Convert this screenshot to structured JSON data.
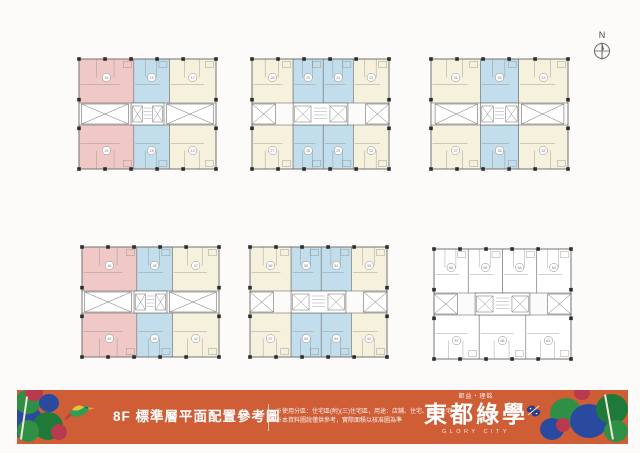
{
  "north_indicator": {
    "label": "N"
  },
  "banner": {
    "bg_color": "#cf5e37",
    "title": "8F 標準層平面配置參考圖",
    "disclaimer_line1": "※使用分區：住宅區(附)(三)住宅區，用途：店鋪、住宅、集合住宅",
    "disclaimer_line2": "※本資料圖說僅供參考，實際面積以核准圖為準",
    "developer": "鉅益・理銘",
    "brand": "東都綠學",
    "brand_en": "GLORY CITY"
  },
  "palette": {
    "pink": "#f0c9c6",
    "blue": "#c2ddec",
    "cream": "#f6f1dc",
    "white": "#ffffff",
    "line": "#6e6e6e",
    "detail": "#8b8b8b",
    "column": "#2d2d2d",
    "treeGreen": "#2f8f45",
    "treeGreenDark": "#1f7a3a",
    "treeBlue": "#2a4a9f",
    "flower": "#b93a4e",
    "trunk": "#efe8d8"
  },
  "plans": [
    {
      "id": "plan-1",
      "rows": [
        {
          "units": [
            {
              "color": "pink",
              "w": 0.4,
              "label": "16"
            },
            {
              "color": "blue",
              "w": 0.26,
              "label": "15"
            },
            {
              "color": "cream",
              "w": 0.34,
              "label": "17"
            }
          ]
        },
        {
          "units": [
            {
              "color": "pink",
              "w": 0.4,
              "label": "19"
            },
            {
              "color": "blue",
              "w": 0.26,
              "label": "18"
            },
            {
              "color": "cream",
              "w": 0.34,
              "label": "12"
            }
          ]
        }
      ],
      "wells": [
        [
          0.02,
          0.36
        ],
        [
          0.64,
          0.98
        ]
      ],
      "core": [
        0.38,
        0.62
      ]
    },
    {
      "id": "plan-2",
      "rows": [
        {
          "units": [
            {
              "color": "cream",
              "w": 0.3,
              "label": "26"
            },
            {
              "color": "blue",
              "w": 0.22,
              "label": "25"
            },
            {
              "color": "blue",
              "w": 0.22,
              "label": "24"
            },
            {
              "color": "cream",
              "w": 0.26,
              "label": "23"
            }
          ]
        },
        {
          "units": [
            {
              "color": "cream",
              "w": 0.3,
              "label": "27"
            },
            {
              "color": "blue",
              "w": 0.22,
              "label": "28"
            },
            {
              "color": "blue",
              "w": 0.22,
              "label": "29"
            },
            {
              "color": "cream",
              "w": 0.26,
              "label": "22"
            }
          ]
        }
      ],
      "wells": [
        [
          0.0,
          0.17
        ],
        [
          0.83,
          1.0
        ]
      ],
      "core": [
        0.3,
        0.7
      ]
    },
    {
      "id": "plan-3",
      "rows": [
        {
          "units": [
            {
              "color": "cream",
              "w": 0.36,
              "label": "36"
            },
            {
              "color": "blue",
              "w": 0.28,
              "label": "35"
            },
            {
              "color": "cream",
              "w": 0.36,
              "label": "33"
            }
          ]
        },
        {
          "units": [
            {
              "color": "cream",
              "w": 0.36,
              "label": "37"
            },
            {
              "color": "blue",
              "w": 0.28,
              "label": "38"
            },
            {
              "color": "cream",
              "w": 0.36,
              "label": "32"
            }
          ]
        }
      ],
      "wells": [
        [
          0.03,
          0.34
        ],
        [
          0.66,
          0.97
        ]
      ],
      "core": [
        0.36,
        0.64
      ]
    },
    {
      "id": "plan-4",
      "rows": [
        {
          "units": [
            {
              "color": "pink",
              "w": 0.4,
              "label": "46"
            },
            {
              "color": "blue",
              "w": 0.26,
              "label": "45"
            },
            {
              "color": "cream",
              "w": 0.34,
              "label": "47"
            }
          ]
        },
        {
          "units": [
            {
              "color": "pink",
              "w": 0.4,
              "label": "49"
            },
            {
              "color": "blue",
              "w": 0.26,
              "label": "48"
            },
            {
              "color": "cream",
              "w": 0.34,
              "label": "42"
            }
          ]
        }
      ],
      "wells": [
        [
          0.02,
          0.36
        ],
        [
          0.64,
          0.98
        ]
      ],
      "core": [
        0.38,
        0.62
      ]
    },
    {
      "id": "plan-5",
      "rows": [
        {
          "units": [
            {
              "color": "cream",
              "w": 0.3,
              "label": "56"
            },
            {
              "color": "blue",
              "w": 0.22,
              "label": "55"
            },
            {
              "color": "blue",
              "w": 0.22,
              "label": "54"
            },
            {
              "color": "cream",
              "w": 0.26,
              "label": "53"
            }
          ]
        },
        {
          "units": [
            {
              "color": "cream",
              "w": 0.3,
              "label": "57"
            },
            {
              "color": "blue",
              "w": 0.22,
              "label": "58"
            },
            {
              "color": "blue",
              "w": 0.22,
              "label": "59"
            },
            {
              "color": "cream",
              "w": 0.26,
              "label": "52"
            }
          ]
        }
      ],
      "wells": [
        [
          0.0,
          0.17
        ],
        [
          0.83,
          1.0
        ]
      ],
      "core": [
        0.3,
        0.7
      ]
    },
    {
      "id": "plan-6",
      "rows": [
        {
          "units": [
            {
              "color": "white",
              "w": 0.25,
              "label": "66"
            },
            {
              "color": "white",
              "w": 0.25,
              "label": "65"
            },
            {
              "color": "white",
              "w": 0.25,
              "label": "64"
            },
            {
              "color": "white",
              "w": 0.25,
              "label": "63"
            }
          ]
        },
        {
          "units": [
            {
              "color": "white",
              "w": 0.33,
              "label": "67"
            },
            {
              "color": "white",
              "w": 0.34,
              "label": "68"
            },
            {
              "color": "white",
              "w": 0.33,
              "label": "62"
            }
          ]
        }
      ],
      "wells": [
        [
          0.0,
          0.17
        ],
        [
          0.83,
          1.0
        ]
      ],
      "core": [
        0.3,
        0.7
      ]
    }
  ]
}
